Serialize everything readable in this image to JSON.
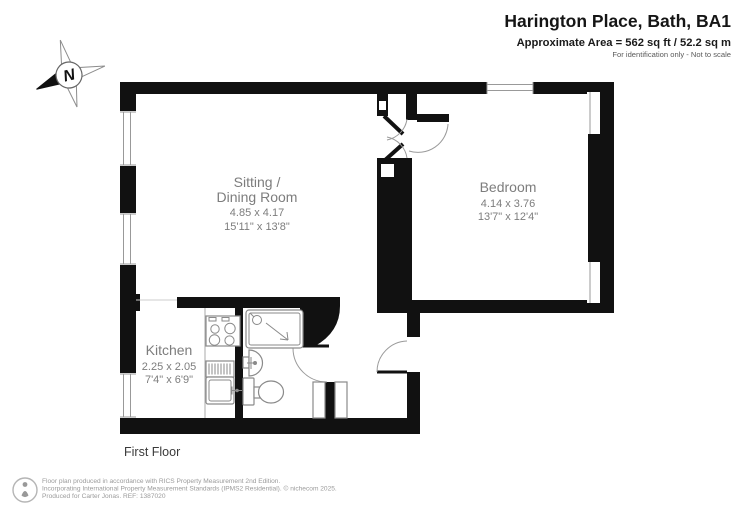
{
  "header": {
    "title": "Harington Place, Bath, BA1",
    "area": "Approximate Area = 562 sq ft / 52.2 sq m",
    "disclaimer": "For identification only - Not to scale"
  },
  "compass": {
    "label": "N"
  },
  "rooms": {
    "sitting": {
      "name_line1": "Sitting /",
      "name_line2": "Dining Room",
      "metric": "4.85 x 4.17",
      "imperial": "15'11\" x 13'8\""
    },
    "bedroom": {
      "name": "Bedroom",
      "metric": "4.14 x 3.76",
      "imperial": "13'7\" x 12'4\""
    },
    "kitchen": {
      "name": "Kitchen",
      "metric": "2.25 x 2.05",
      "imperial": "7'4\" x 6'9\""
    }
  },
  "floor_label": "First Floor",
  "footer": {
    "line1": "Floor plan produced in accordance with RICS Property Measurement 2nd Edition.",
    "line2": "Incorporating International Property Measurement Standards (IPMS2 Residential).  © nichecom 2025.",
    "line3": "Produced for Carter Jonas.   REF: 1387020",
    "ref": "1387020"
  },
  "colors": {
    "wall": "#111111",
    "room_label": "#7d7d7d",
    "fixture_outline": "#8a8a8a",
    "window_line": "#999999",
    "footer_text": "#9b9b9b"
  }
}
